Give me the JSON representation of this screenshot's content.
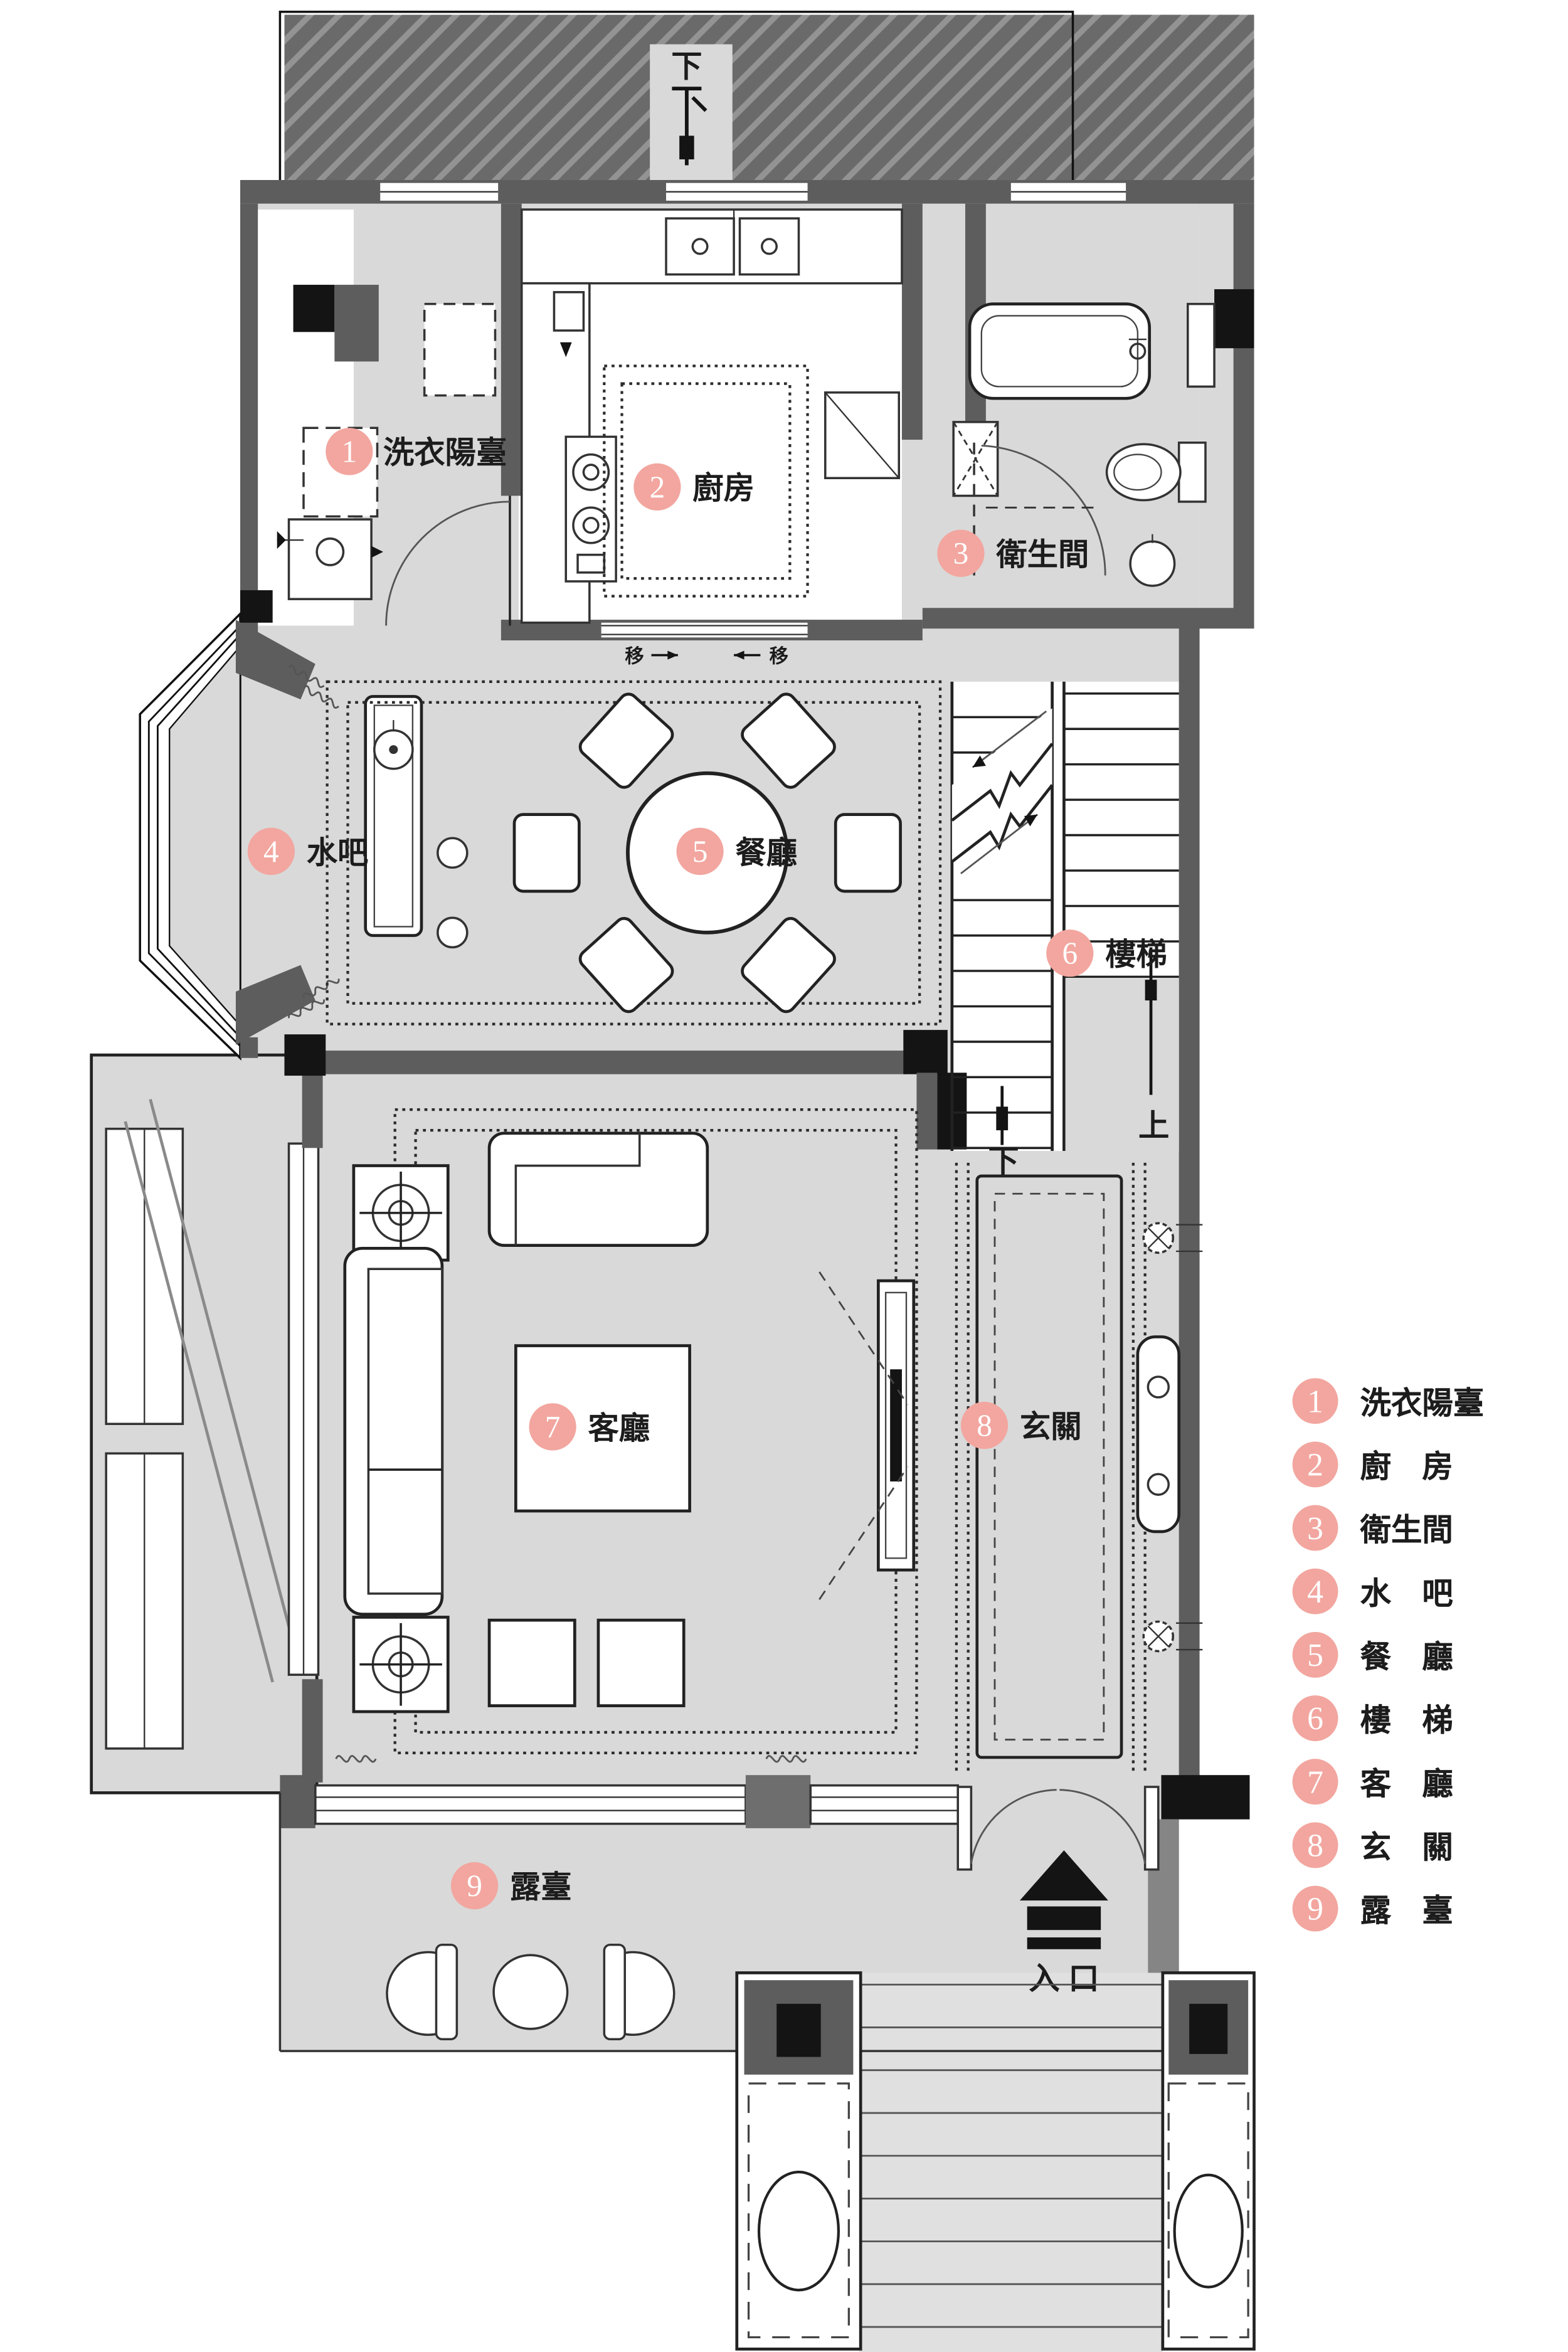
{
  "title": "別墅一層平面配置圖",
  "colors": {
    "floor": "#d9d9d9",
    "wall": "#5d5d5d",
    "accent_pink": "#f2a69f",
    "black": "#141414"
  },
  "rooms": [
    {
      "num": "1",
      "label": "洗衣陽臺"
    },
    {
      "num": "2",
      "label": "廚房"
    },
    {
      "num": "3",
      "label": "衛生間"
    },
    {
      "num": "4",
      "label": "水吧"
    },
    {
      "num": "5",
      "label": "餐廳"
    },
    {
      "num": "6",
      "label": "樓梯"
    },
    {
      "num": "7",
      "label": "客廳"
    },
    {
      "num": "8",
      "label": "玄關"
    },
    {
      "num": "9",
      "label": "露臺"
    }
  ],
  "legend": [
    {
      "num": "1",
      "label": "洗衣陽臺"
    },
    {
      "num": "2",
      "label": "廚　房"
    },
    {
      "num": "3",
      "label": "衛生間"
    },
    {
      "num": "4",
      "label": "水　吧"
    },
    {
      "num": "5",
      "label": "餐　廳"
    },
    {
      "num": "6",
      "label": "樓　梯"
    },
    {
      "num": "7",
      "label": "客　廳"
    },
    {
      "num": "8",
      "label": "玄　關"
    },
    {
      "num": "9",
      "label": "露　臺"
    }
  ],
  "annotations": {
    "balcony_down": "下",
    "stair_up": "上",
    "stair_down": "下",
    "entrance": "入 口",
    "slide": "移"
  }
}
